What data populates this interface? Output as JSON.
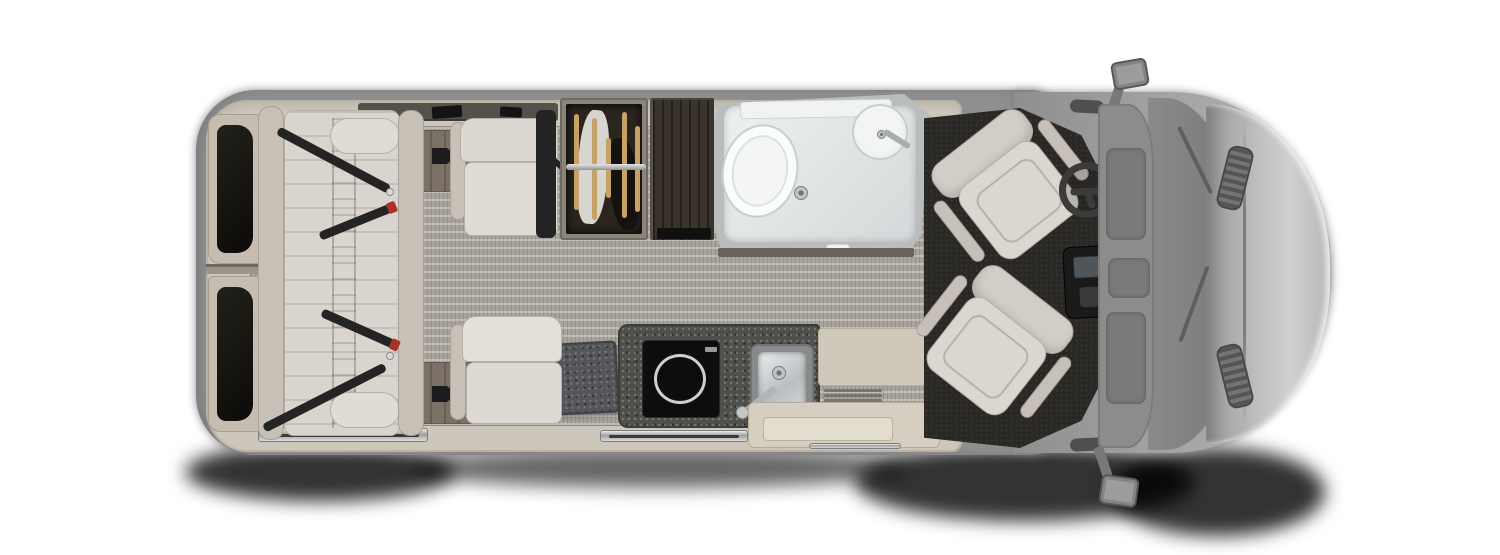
{
  "meta": {
    "description": "Top-down 3D floor plan rendering of a Class B camper van interior; image contains no readable text",
    "canvas_width": 1500,
    "canvas_height": 555
  },
  "colors": {
    "body": "#8f8f8f",
    "hood_silver": "#d0d0d0",
    "windshield": "#7f7f7f",
    "wall": "#cdc6ba",
    "carpet": "#a9a49b",
    "wood": "#7c7166",
    "upholstery": "#d9d4cd",
    "upholstery_dark": "#c7c1b8",
    "belt": "#242424",
    "belt_buckle_red": "#a8322a",
    "wardrobe_interior": "#2b251f",
    "hanger_gold": "#c7a266",
    "cabinet_wood": "#3a332c",
    "bath_floor": "#d4d8d9",
    "fixture_white": "#fbfcfd",
    "counter": "#4f504b",
    "cooktop": "#0d0d0d",
    "steel": "#c6cacb",
    "table": "#54565a",
    "cab_floor": "#2a2824",
    "shadow": "#000000"
  },
  "components": {
    "exterior": [
      "van-body",
      "hood",
      "windshield",
      "headlight-top",
      "headlight-bottom",
      "side-mirror-top",
      "side-mirror-bottom",
      "ground-shadow"
    ],
    "rear_area": [
      "rear-door-window-top",
      "rear-door-window-bottom",
      "rear-bench-sofa",
      "seat-belt-1",
      "seat-belt-2",
      "seat-belt-3",
      "seat-belt-4"
    ],
    "living_area": [
      "aisle-carpet",
      "wood-floor-strip-top",
      "wood-floor-strip-bottom",
      "seat-anchor-top",
      "seat-anchor-bottom",
      "lounge-seat-top",
      "lounge-seat-bottom",
      "belt-pillar",
      "wardrobe-with-hangers",
      "tall-cabinet",
      "side-table",
      "entry-step",
      "door-sill"
    ],
    "wet_bath": [
      "toilet",
      "corner-sink",
      "floor-drain",
      "shelf"
    ],
    "galley": [
      "kitchen-counter",
      "induction-cooktop",
      "stainless-sink",
      "faucet",
      "floor-vent"
    ],
    "cab": [
      "cab-floor-mat",
      "driver-swivel-seat",
      "passenger-swivel-seat",
      "steering-wheel",
      "center-console",
      "dashboard"
    ]
  }
}
